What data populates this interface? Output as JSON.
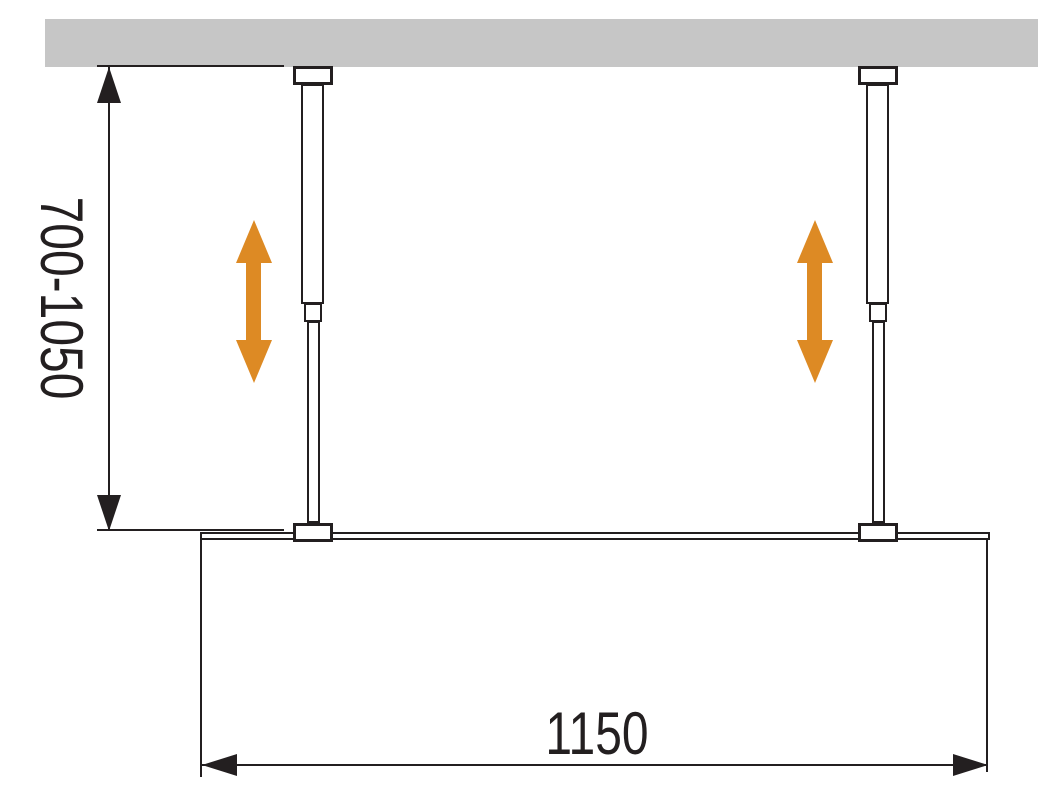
{
  "diagram": {
    "type": "technical-dimension-drawing",
    "subject": "walk-in glass shower panel with ceiling-mounted telescopic support bars",
    "vertical_dimension_label": "700-1050",
    "horizontal_dimension_label": "1150"
  },
  "icons": {
    "height_adjust": "double-vertical-arrow",
    "dimension_ends": "triangle-arrowheads"
  },
  "colors": {
    "line_black": "#231F20",
    "accent_orange": "#DD8A24",
    "ceiling_gray": "#C6C6C6",
    "background": "#FFFFFF"
  }
}
